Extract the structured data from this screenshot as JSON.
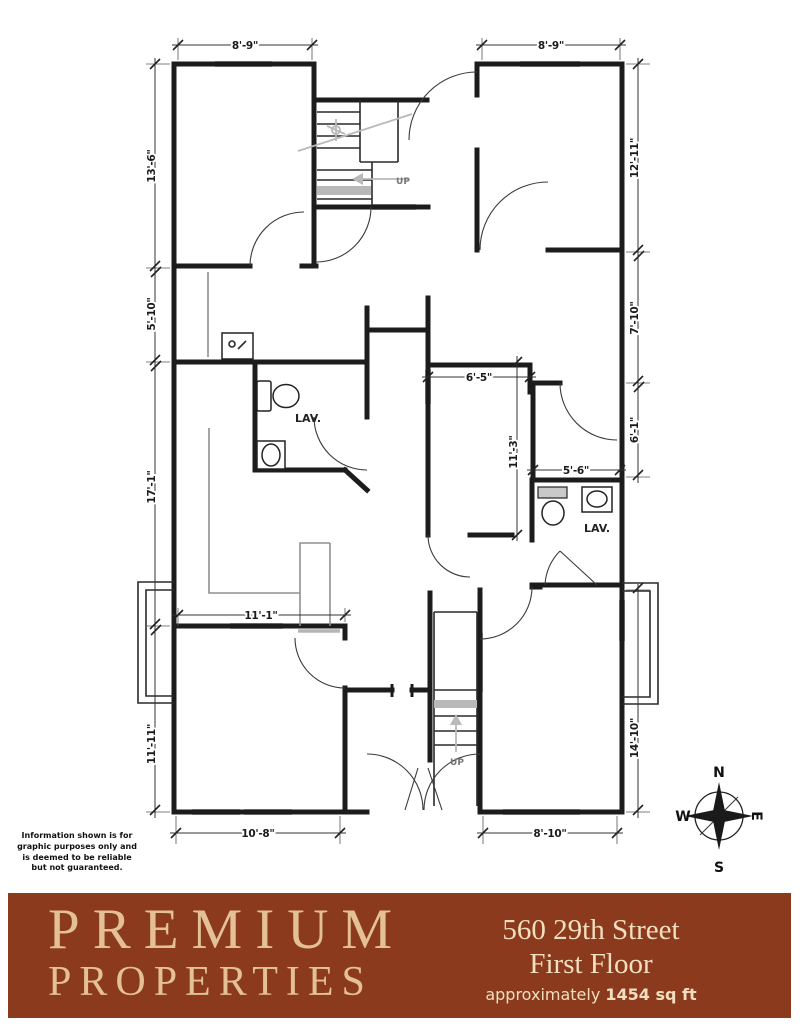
{
  "plan": {
    "dims": {
      "tl_top": "8'-9\"",
      "tr_top": "8'-9\"",
      "left1": "13'-6\"",
      "left2": "5'-10\"",
      "left3": "17'-1\"",
      "left4": "11'-11\"",
      "right1": "12'-11\"",
      "right2": "7'-10\"",
      "right3": "6'-1\"",
      "right4": "14'-10\"",
      "in_65": "6'-5\"",
      "in_113": "11'-3\"",
      "in_56": "5'-6\"",
      "in_111": "11'-1\"",
      "bot_l": "10'-8\"",
      "bot_r": "8'-10\""
    },
    "labels": {
      "lav1": "LAV.",
      "lav2": "LAV.",
      "up1": "UP",
      "up2": "UP"
    },
    "compass": {
      "n": "N",
      "s": "S",
      "w": "W",
      "e": "E"
    }
  },
  "disclaimer": "Information shown is for graphic purposes only and is deemed to be reliable but not guaranteed.",
  "footer": {
    "brand_line1": "PREMIUM",
    "brand_line2": "PROPERTIES",
    "address_line1": "560 29th Street",
    "address_line2": "First Floor",
    "approx_prefix": "approximately ",
    "approx_value": "1454 sq ft"
  },
  "colors": {
    "banner_bg": "#8B3A1E",
    "banner_text": "#F2DFC0",
    "brand_text": "#E3C096"
  }
}
